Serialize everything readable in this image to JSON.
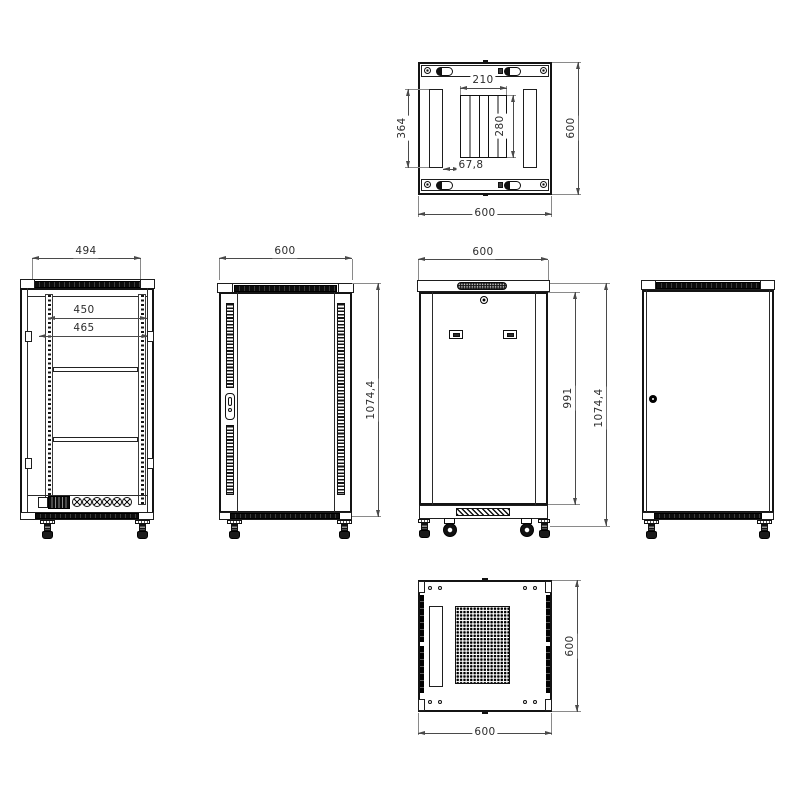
{
  "drawing": {
    "name": "network-cabinet-orthographic-views",
    "line_color": "#141414",
    "dim_color": "#4a4a4a"
  },
  "views": {
    "top": {
      "dim_fan_width": "210",
      "dim_fan_depth": "280",
      "dim_vent_length": "364",
      "dim_offset": "67,8",
      "dim_depth": "600",
      "dim_width": "600"
    },
    "front_open": {
      "dim_frame_width": "494",
      "dim_rail_width": "450",
      "dim_opening_width": "465"
    },
    "front": {
      "dim_width": "600",
      "dim_height": "1074,4"
    },
    "rear": {
      "dim_width": "600",
      "dim_body_height": "991",
      "dim_height": "1074,4"
    },
    "bottom": {
      "dim_depth": "600",
      "dim_width": "600"
    }
  }
}
